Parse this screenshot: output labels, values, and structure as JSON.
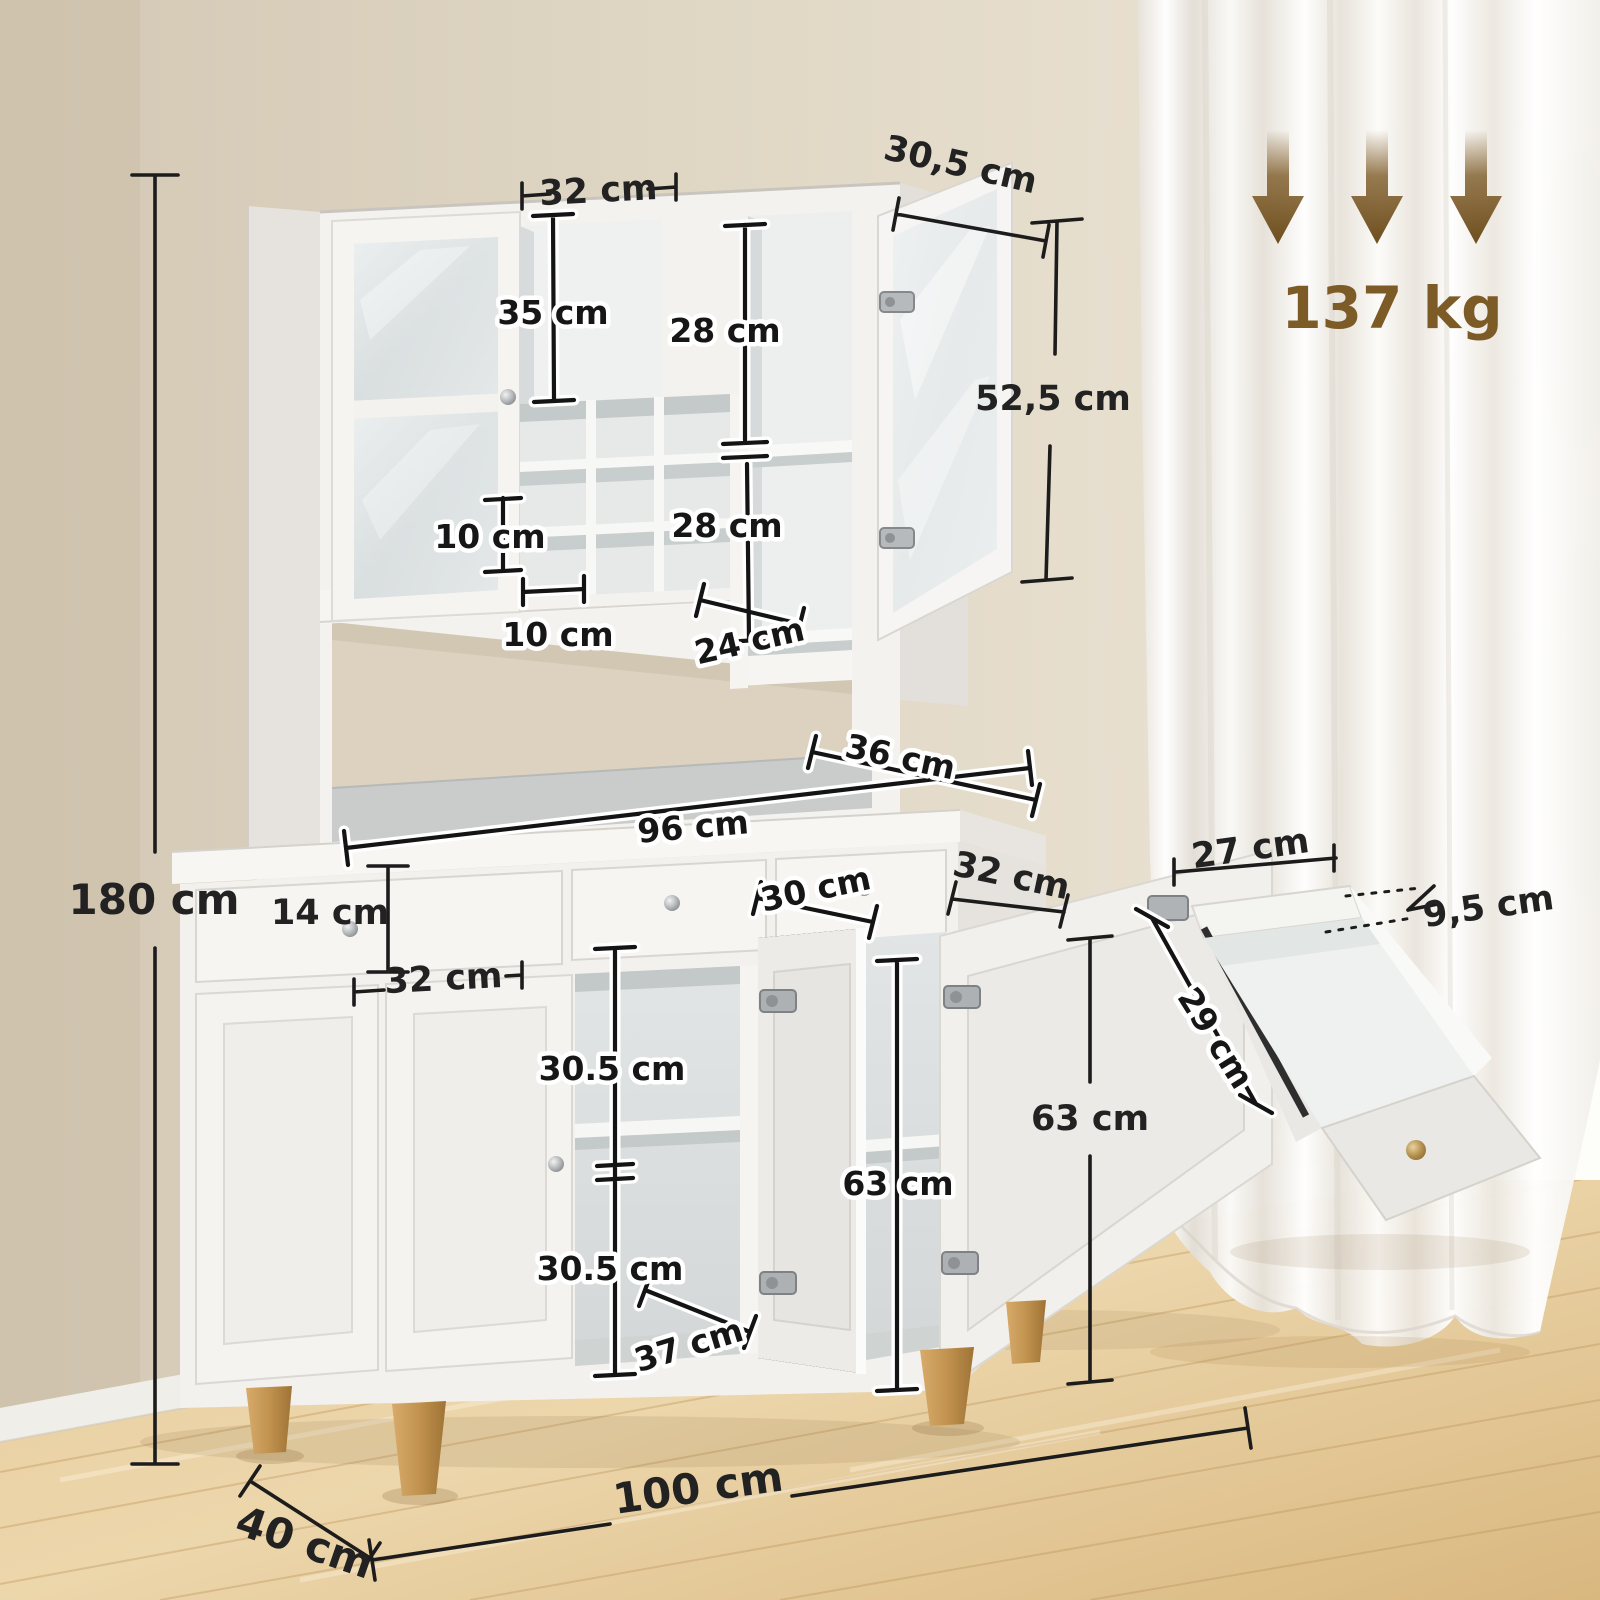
{
  "scene": {
    "kind": "furniture-dimension-diagram",
    "subject": "white kitchen buffet hutch cabinet with wine rack, three drawers and four doors, in room with beige wall, sheer curtains and wood floor"
  },
  "style": {
    "label_color": "#1c1c1c",
    "label_outline": "#ffffff",
    "accent_brown": "#7d5b27"
  },
  "load": {
    "weight": "137 kg",
    "arrow_icon": "down-arrow",
    "arrow_count": 3
  },
  "dims": {
    "top_compartment_width": "32 cm",
    "hutch_depth": "30,5 cm",
    "top_compartment_height": "35 cm",
    "upper_shelf_height_1": "28 cm",
    "upper_shelf_height_2": "28 cm",
    "glass_door_height": "52,5 cm",
    "cubby_height": "10 cm",
    "cubby_width": "10 cm",
    "upper_right_shelf_width": "24 cm",
    "worktop_depth": "36 cm",
    "worktop_width": "96 cm",
    "drawer_front_height": "14 cm",
    "left_door_width": "32 cm",
    "middle_opening_width": "30 cm",
    "base_top_depth": "32 cm",
    "shelf_space_upper": "30.5 cm",
    "shelf_space_lower": "30.5 cm",
    "middle_shelf_width": "37 cm",
    "base_door_height_inner": "63 cm",
    "base_door_height_outer": "63 cm",
    "overall_height": "180 cm",
    "overall_width": "100 cm",
    "overall_depth": "40 cm",
    "drawer_inner_width": "27 cm",
    "drawer_inner_height": "9,5 cm",
    "drawer_inner_depth": "29 cm"
  }
}
